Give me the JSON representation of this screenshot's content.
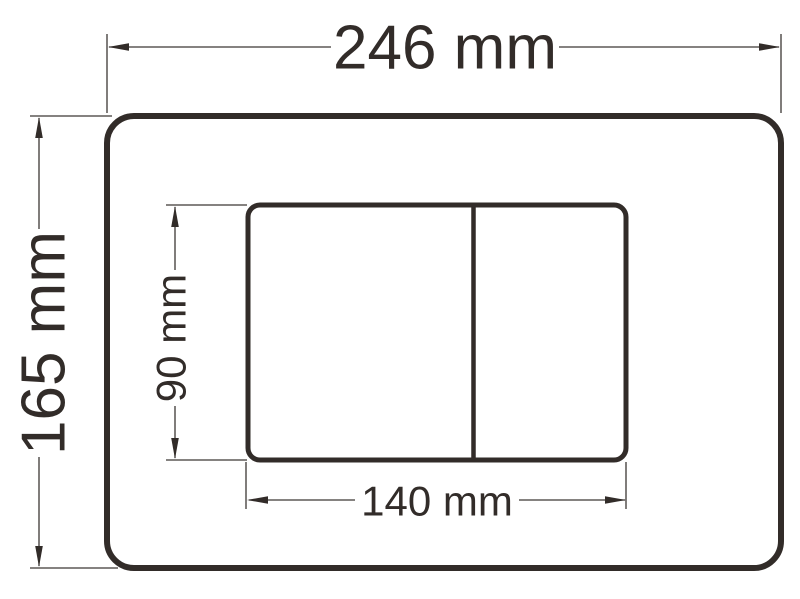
{
  "drawing": {
    "type": "dimensioned technical drawing",
    "subject": "flush plate front view with two buttons",
    "unit": "mm",
    "colors": {
      "line": "#322c29",
      "background": "#ffffff"
    },
    "dimensions": {
      "plate_width": {
        "label": "246 mm",
        "value": 246
      },
      "plate_height": {
        "label": "165 mm",
        "value": 165
      },
      "button_panel_height": {
        "label": "90 mm",
        "value": 90
      },
      "button_panel_width": {
        "label": "140 mm",
        "value": 140
      }
    }
  }
}
